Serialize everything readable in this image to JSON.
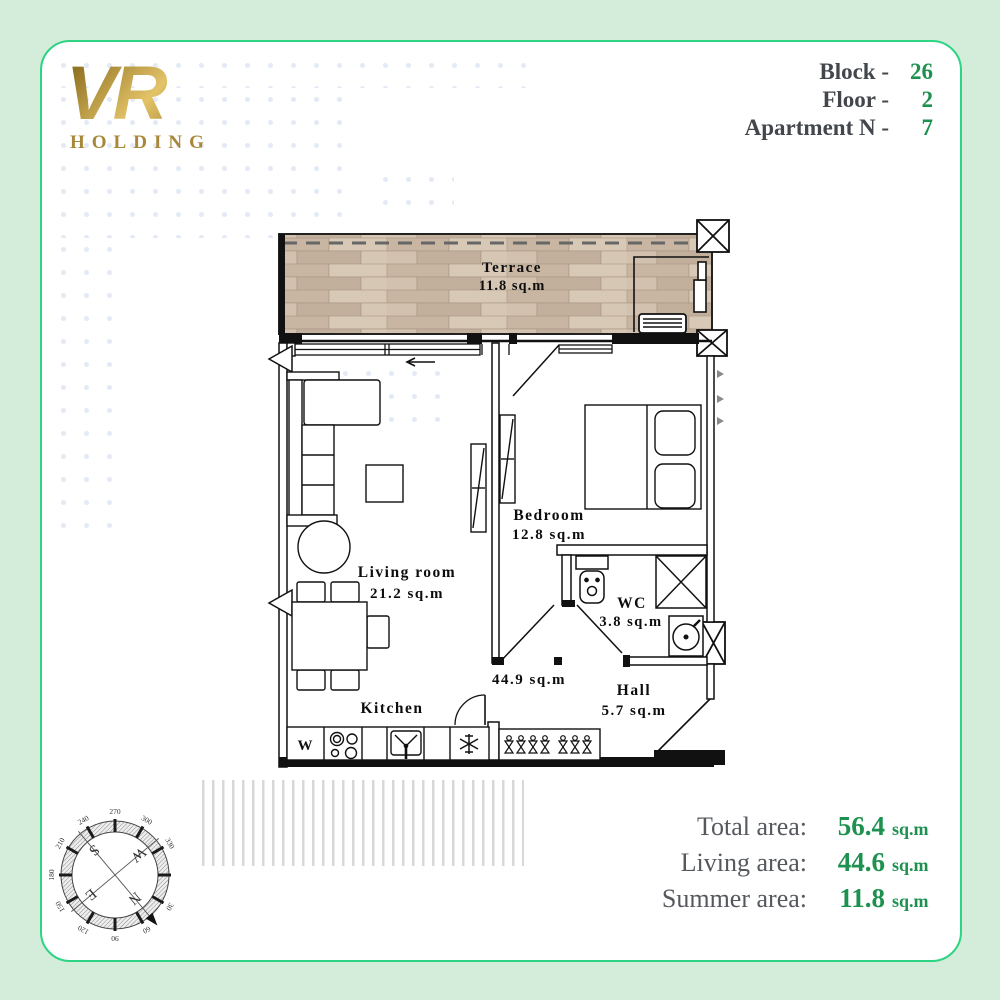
{
  "brand": {
    "vr": "VR",
    "holding": "HOLDING"
  },
  "header": {
    "rows": [
      {
        "label": "Block -",
        "value": "26"
      },
      {
        "label": "Floor -",
        "value": "2"
      },
      {
        "label": "Apartment N -",
        "value": "7"
      }
    ]
  },
  "plan": {
    "terrace": {
      "name": "Terrace",
      "area": "11.8 sq.m"
    },
    "living": {
      "name": "Living room",
      "area": "21.2 sq.m"
    },
    "bedroom": {
      "name": "Bedroom",
      "area": "12.8 sq.m"
    },
    "wc": {
      "name": "WC",
      "area": "3.8 sq.m"
    },
    "hall": {
      "name": "Hall",
      "area": "5.7 sq.m"
    },
    "kitchen": {
      "name": "Kitchen"
    },
    "inner_area": "44.9 sq.m",
    "washer_label": "W"
  },
  "areas": {
    "rows": [
      {
        "label": "Total area:",
        "value": "56.4",
        "unit": "sq.m"
      },
      {
        "label": "Living area:",
        "value": "44.6",
        "unit": "sq.m"
      },
      {
        "label": "Summer area:",
        "value": "11.8",
        "unit": "sq.m"
      }
    ]
  },
  "compass": {
    "degrees": [
      "30",
      "60",
      "90",
      "120",
      "150",
      "180",
      "210",
      "240",
      "270",
      "300",
      "330"
    ],
    "n": "N",
    "s": "S",
    "e": "E",
    "w": "W"
  },
  "colors": {
    "accent_green": "#2cd483",
    "value_green": "#1e9150",
    "gold": "#a8873a",
    "page_bg": "#d3edda"
  }
}
